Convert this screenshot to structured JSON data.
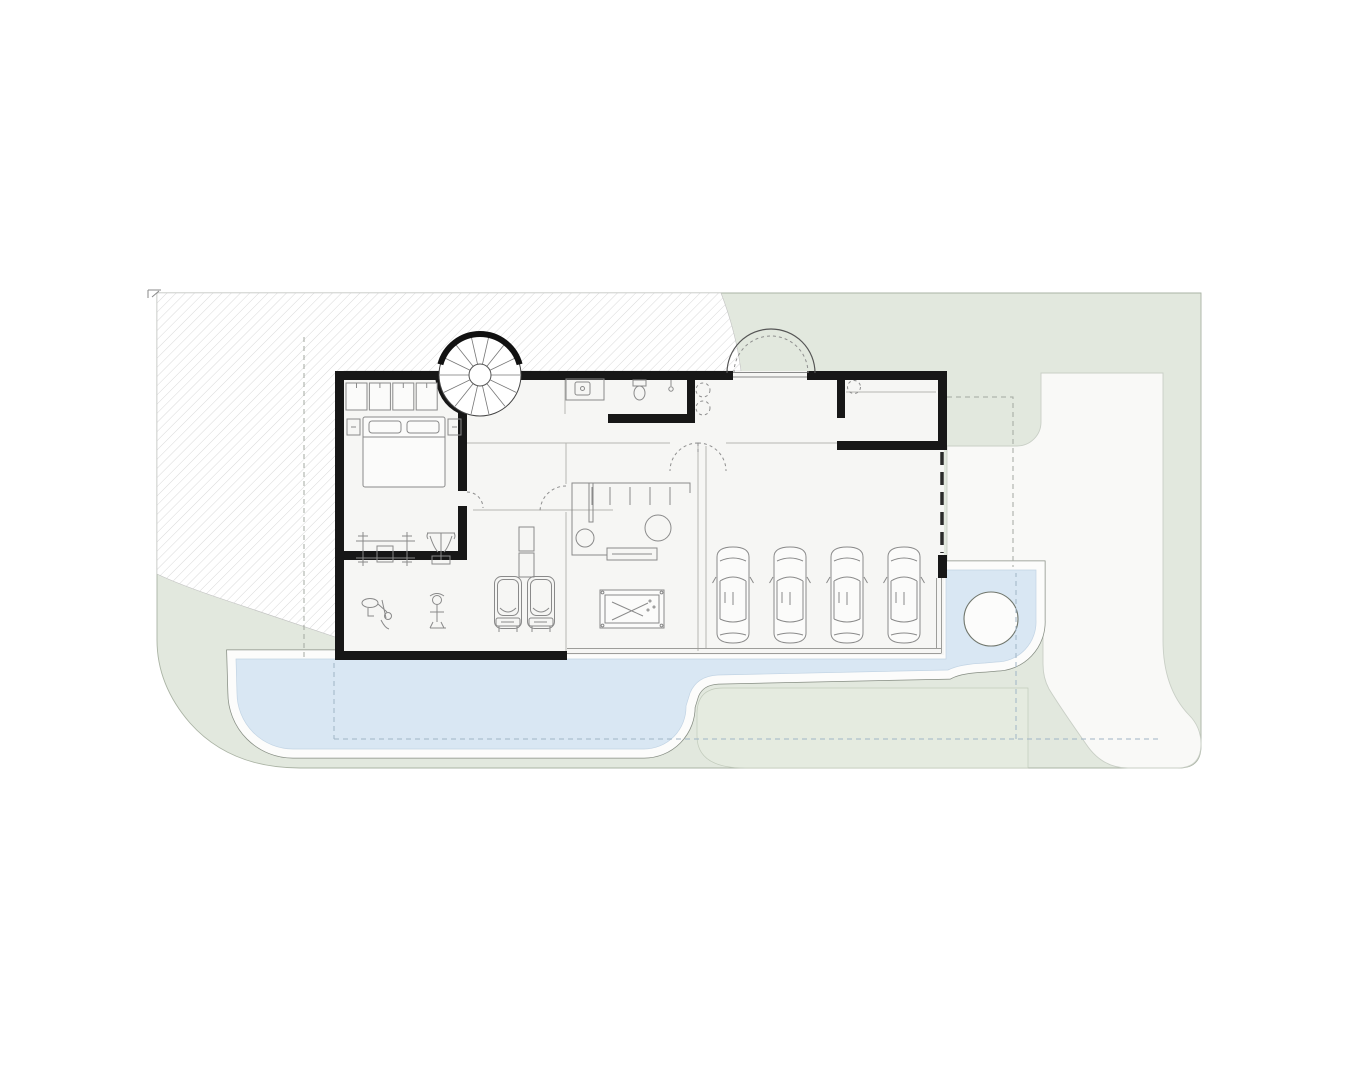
{
  "colors": {
    "page_bg": "#ffffff",
    "lawn_green": "#e2e8de",
    "lawn_green_light": "#e5ebe0",
    "pool_blue": "#d9e7f3",
    "deck_white": "#fcfcfb",
    "deck_edge": "#868d83",
    "path_white": "#f9f9f7",
    "floor_white": "#f6f6f4",
    "wall_black": "#171717",
    "hatch_line": "#c9c9c9",
    "furniture_gray": "#8a8a8a",
    "car_gray": "#7a7a7a",
    "dash_gray": "#a3a8a0",
    "dash_blue": "#9fb4c6"
  },
  "garage": {
    "car_count": 4,
    "car_first_x": 712,
    "car_spacing": 57,
    "car_y": 545
  },
  "gym": {
    "treadmill_count": 2,
    "treadmill_first_x": 494,
    "treadmill_spacing": 33,
    "treadmill_y": 576
  },
  "stair": {
    "tread_count": 14,
    "center_x": 480,
    "center_y": 375,
    "outer_r": 40,
    "inner_r": 11
  },
  "closet": {
    "cell_count": 4,
    "first_x": 346,
    "cell_w": 21,
    "gap": 2.4,
    "y": 383,
    "cell_h": 27
  },
  "bar": {
    "stool_xs": [
      592,
      610,
      630,
      650,
      670
    ],
    "stool_top_y": 487,
    "stool_bottom_y": 505
  }
}
